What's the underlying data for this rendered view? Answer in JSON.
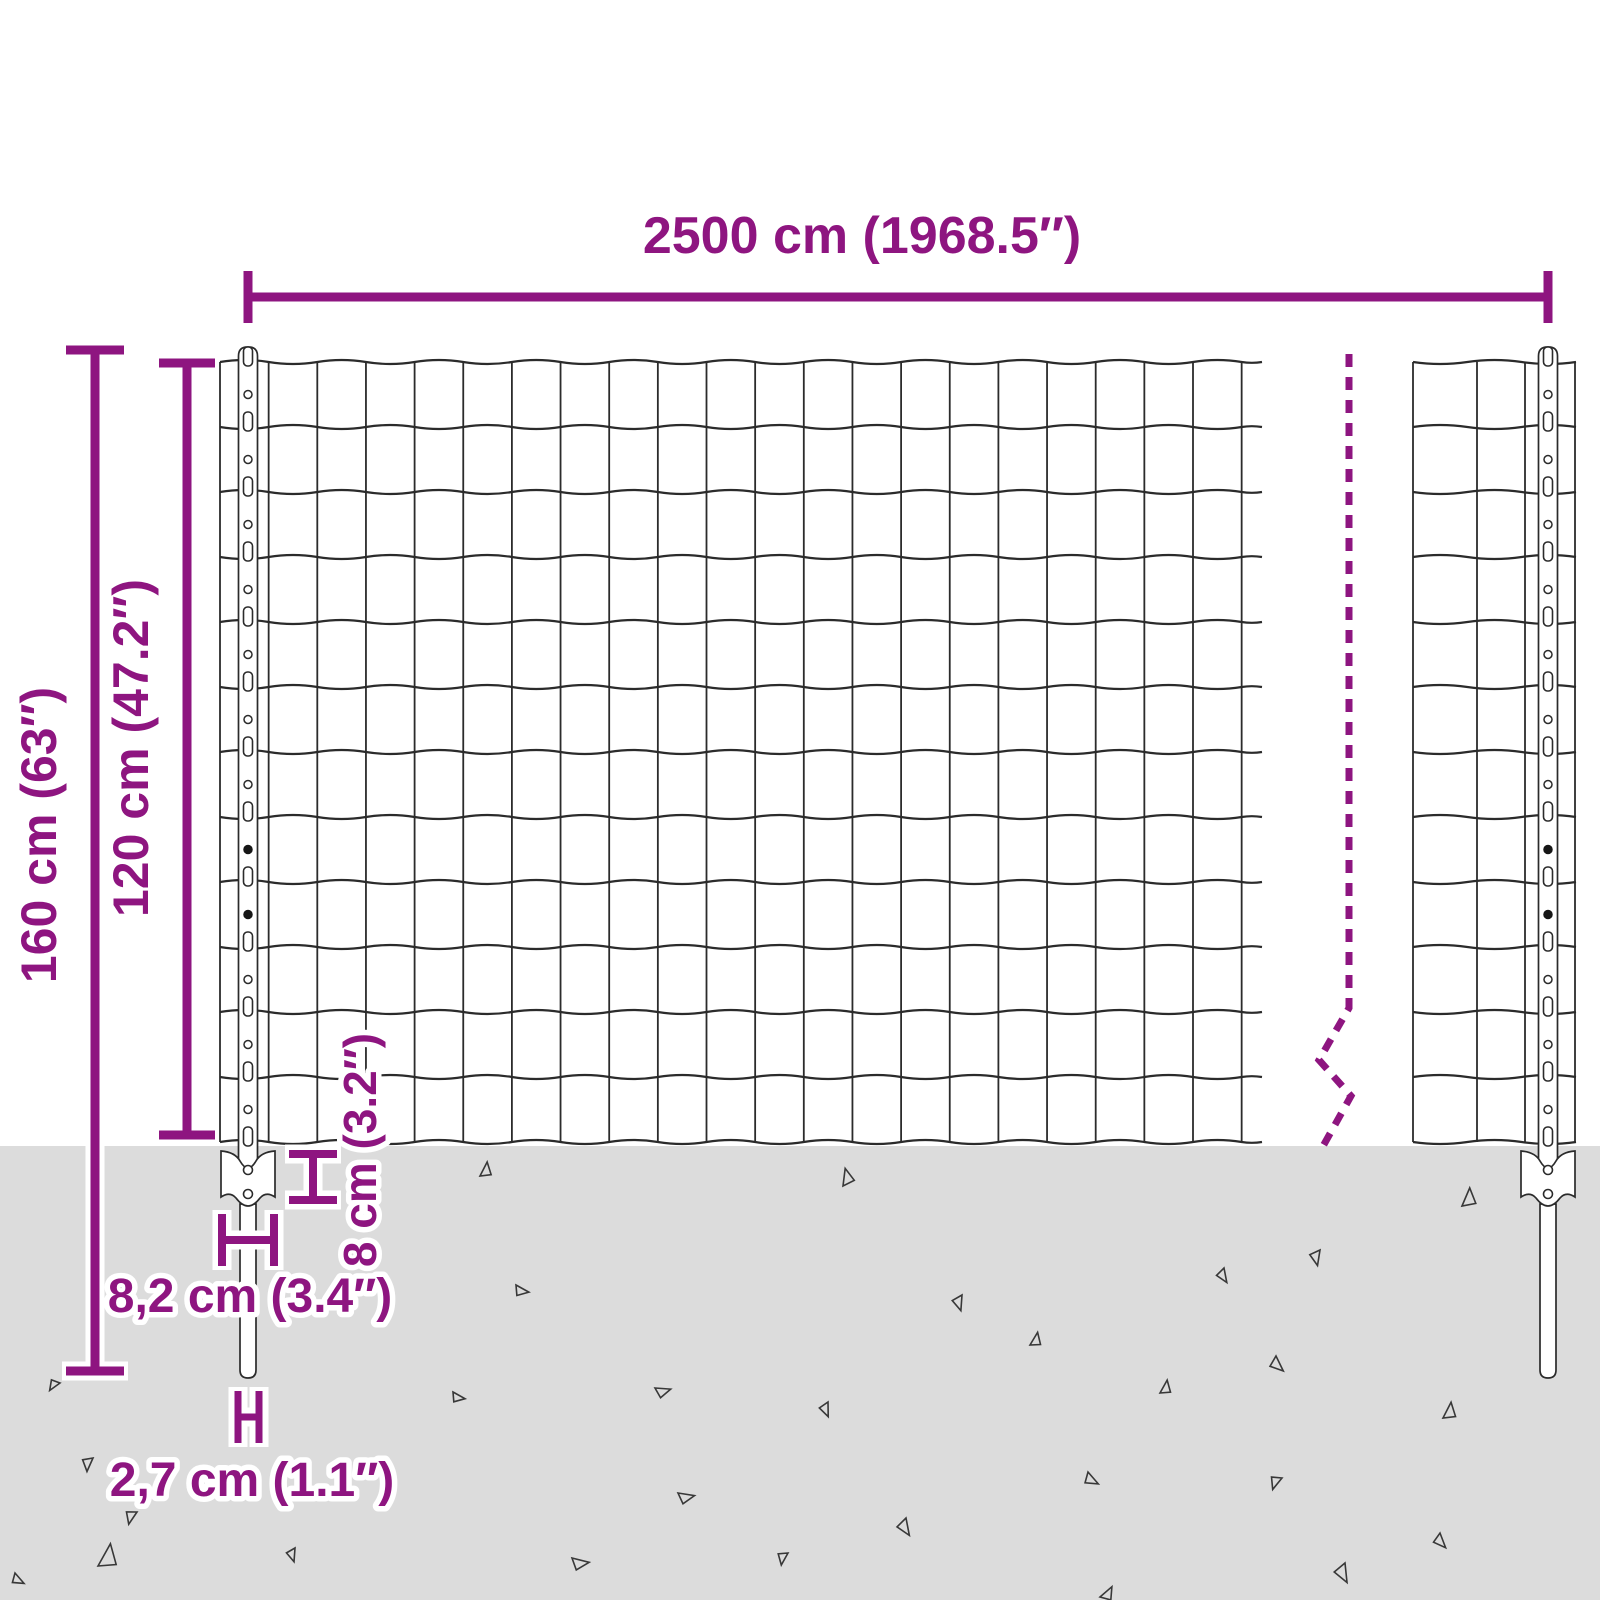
{
  "diagram": {
    "type": "product-dimension-diagram",
    "subject": "garden wire mesh fence panel with posts and ground spike anchors"
  },
  "labels": {
    "total_width": "2500 cm (1968.5″)",
    "total_height": "160 cm (63″)",
    "fence_height": "120 cm (47.2″)",
    "anchor_plate_height": "8 cm (3.2″)",
    "anchor_plate_width": "8,2 cm (3.4″)",
    "spike_width": "2,7 cm (1.1″)"
  },
  "colors": {
    "accent": "#8E1580",
    "ground": "#DCDCDC",
    "wire": "#2B2B2B",
    "post_outline": "#2B2B2B",
    "hole_fill": "#161616",
    "background": "#FFFFFF"
  },
  "fence": {
    "rows": 12,
    "row_pitch": 65,
    "mesh_top_y": 362,
    "main_span": [
      220,
      1262
    ],
    "main_wire_pitch": 48.65,
    "main_vertical_count": 22,
    "right_span": [
      1413,
      1576
    ],
    "right_verticals": [
      1413,
      1477,
      1525,
      1575
    ],
    "wave_amplitude": 4,
    "post_centers": [
      248,
      1548
    ],
    "post_width": 19,
    "post_top_y": 347,
    "ground_top_y": 1146,
    "plate": {
      "half_width": 27,
      "top": 1151,
      "bottom": 1206
    },
    "spike": {
      "width": 16,
      "top": 1204,
      "bottom": 1378
    },
    "filled_hole_rows": [
      7,
      8
    ]
  },
  "break_line": {
    "x": 1349,
    "top": 354,
    "zigzag": [
      [
        1349,
        1008
      ],
      [
        1319,
        1060
      ],
      [
        1351,
        1096
      ],
      [
        1322,
        1148
      ]
    ],
    "dash": "13 10",
    "width": 7
  },
  "ground": {
    "specks": [
      [
        480,
        1176,
        16,
        8
      ],
      [
        843,
        1186,
        18,
        -12
      ],
      [
        1462,
        1206,
        20,
        4
      ],
      [
        1224,
        1268,
        15,
        150
      ],
      [
        1320,
        1250,
        16,
        170
      ],
      [
        962,
        1295,
        16,
        165
      ],
      [
        516,
        1285,
        15,
        100
      ],
      [
        350,
        1301,
        12,
        150
      ],
      [
        1030,
        1345,
        15,
        12
      ],
      [
        1276,
        1356,
        17,
        135
      ],
      [
        60,
        1383,
        13,
        215
      ],
      [
        453,
        1392,
        14,
        100
      ],
      [
        655,
        1388,
        16,
        75
      ],
      [
        1160,
        1393,
        15,
        10
      ],
      [
        828,
        1402,
        15,
        160
      ],
      [
        1443,
        1418,
        18,
        8
      ],
      [
        93,
        1458,
        15,
        185
      ],
      [
        1088,
        1472,
        16,
        120
      ],
      [
        1282,
        1478,
        15,
        200
      ],
      [
        678,
        1493,
        17,
        80
      ],
      [
        137,
        1512,
        15,
        195
      ],
      [
        906,
        1518,
        18,
        150
      ],
      [
        295,
        1548,
        14,
        165
      ],
      [
        572,
        1558,
        18,
        85
      ],
      [
        788,
        1553,
        14,
        190
      ],
      [
        1345,
        1563,
        20,
        155
      ],
      [
        1440,
        1533,
        16,
        140
      ],
      [
        98,
        1566,
        26,
        10
      ],
      [
        1100,
        1597,
        16,
        30
      ],
      [
        15,
        1573,
        14,
        120
      ]
    ]
  }
}
